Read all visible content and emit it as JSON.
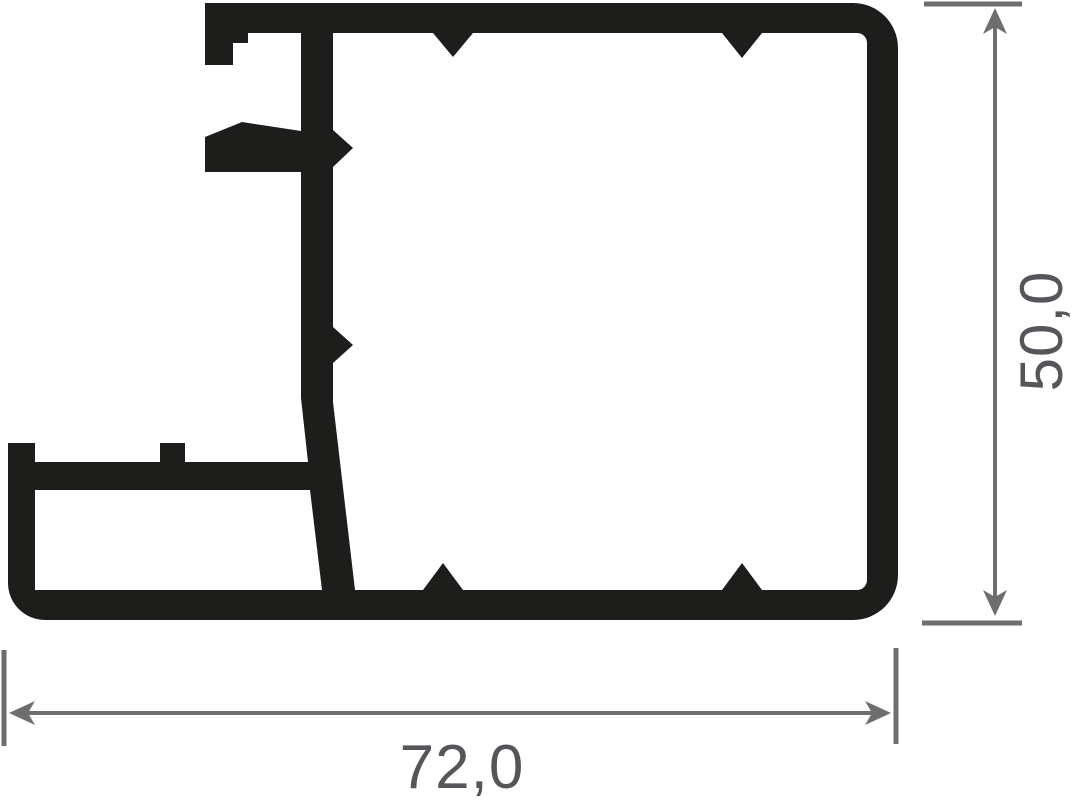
{
  "drawing": {
    "background_color": "#ffffff",
    "profile_color": "#1d1d1b",
    "dimension_line_color": "#6d6e70",
    "dimension_text_color": "#55565a"
  },
  "dimensions": {
    "width_label": "72,0",
    "height_label": "50,0"
  }
}
